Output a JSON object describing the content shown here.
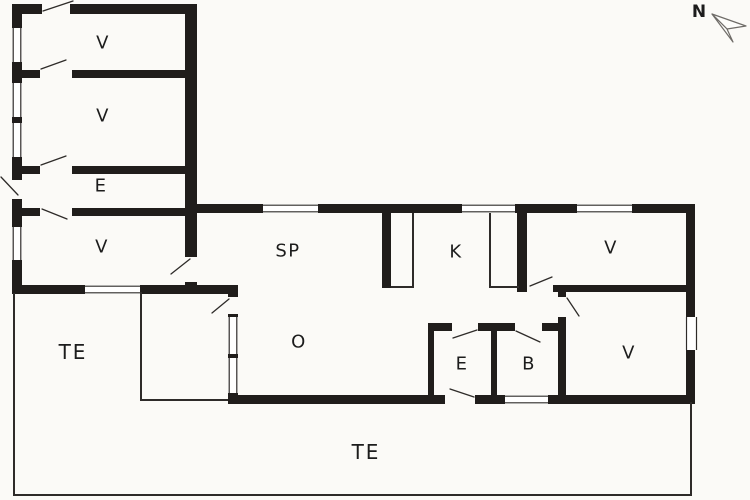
{
  "page": {
    "type": "floor-plan"
  },
  "colors": {
    "wall": "#201d1b",
    "thin": "#2e2b29",
    "label": "#1c1c1c",
    "background": "#fbfaf7"
  },
  "compass": {
    "north_label": "N"
  },
  "rooms": [
    {
      "id": "v-room-top-1",
      "label": "V"
    },
    {
      "id": "v-room-top-2",
      "label": "V"
    },
    {
      "id": "e-hall-annex",
      "label": "E"
    },
    {
      "id": "v-room-top-3",
      "label": "V"
    },
    {
      "id": "sp-room",
      "label": "SP"
    },
    {
      "id": "k-kitchen",
      "label": "K"
    },
    {
      "id": "v-room-right-top",
      "label": "V"
    },
    {
      "id": "o-living-room",
      "label": "O"
    },
    {
      "id": "e-hall-small",
      "label": "E"
    },
    {
      "id": "b-bathroom",
      "label": "B"
    },
    {
      "id": "v-room-right-bottom",
      "label": "V"
    },
    {
      "id": "te-terrace-west",
      "label": "TE"
    },
    {
      "id": "te-terrace-south",
      "label": "TE"
    }
  ]
}
